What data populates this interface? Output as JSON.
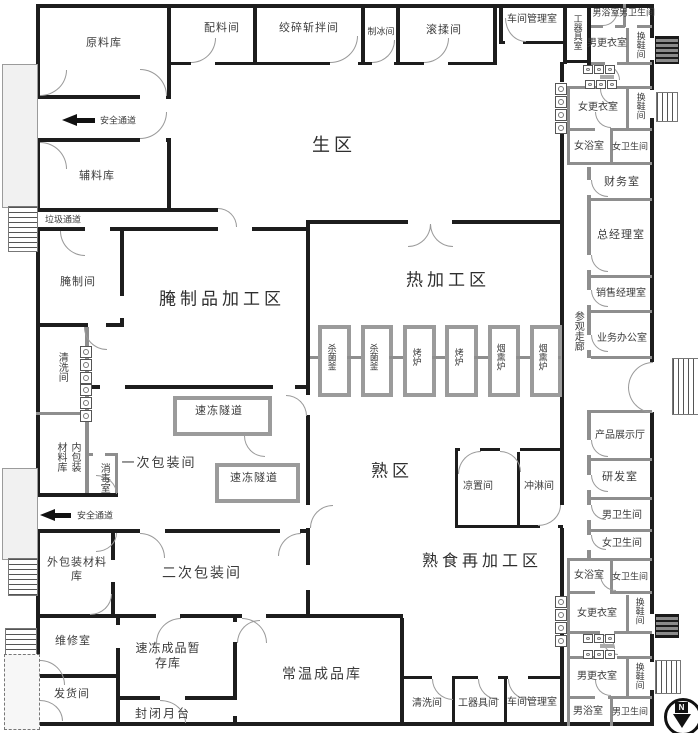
{
  "zones": {
    "raw_area": "生区",
    "cured_processing": "腌制品加工区",
    "hot_processing": "热加工区",
    "cooked_area": "熟区",
    "cooked_reprocessing": "熟食再加工区",
    "primary_packaging": "一次包装间",
    "secondary_packaging": "二次包装间",
    "visitor_corridor": "参观走廊"
  },
  "rooms": {
    "raw_material_store": "原料库",
    "ingredient_room": "配料间",
    "grinding_chopping_room": "绞碎斩拌间",
    "ice_making_room": "制冰间",
    "tumbling_room": "滚揉间",
    "workshop_management_office": "车间管理室",
    "tool_room": "工器具室",
    "tool_room_b": "工器具间",
    "mens_bath": "男浴室",
    "mens_toilet": "男卫生间",
    "mens_locker": "男更衣室",
    "womens_bath": "女浴室",
    "womens_toilet": "女卫生间",
    "womens_locker": "女更衣室",
    "shoe_change_room": "换鞋间",
    "finance_office": "财务室",
    "general_manager_office": "总经理室",
    "sales_manager_office": "销售经理室",
    "business_office": "业务办公室",
    "product_showroom": "产品展示厅",
    "rnd_office": "研发室",
    "aux_material_store": "辅料库",
    "curing_room": "腌制间",
    "washing_room": "清洗间",
    "inner_packaging_store": "内包装材料库",
    "disinfection_room": "消毒室",
    "outer_packaging_store": "外包装材料库",
    "maintenance_room": "维修室",
    "dispatch_room": "发货间",
    "frozen_goods_store": "速冻成品暂存库",
    "enclosed_platform": "封闭月台",
    "ambient_goods_store": "常温成品库",
    "cooling_room": "凉置间",
    "shower_room": "冲淋间",
    "freeze_tunnel": "速冻隧道"
  },
  "equipment": {
    "sterilizer": "杀菌釜",
    "oven": "烤炉",
    "smoker": "烟熏炉"
  },
  "annotations": {
    "safety_passage": "安全通道",
    "garbage_passage": "垃圾通道",
    "compass_north": "N"
  }
}
